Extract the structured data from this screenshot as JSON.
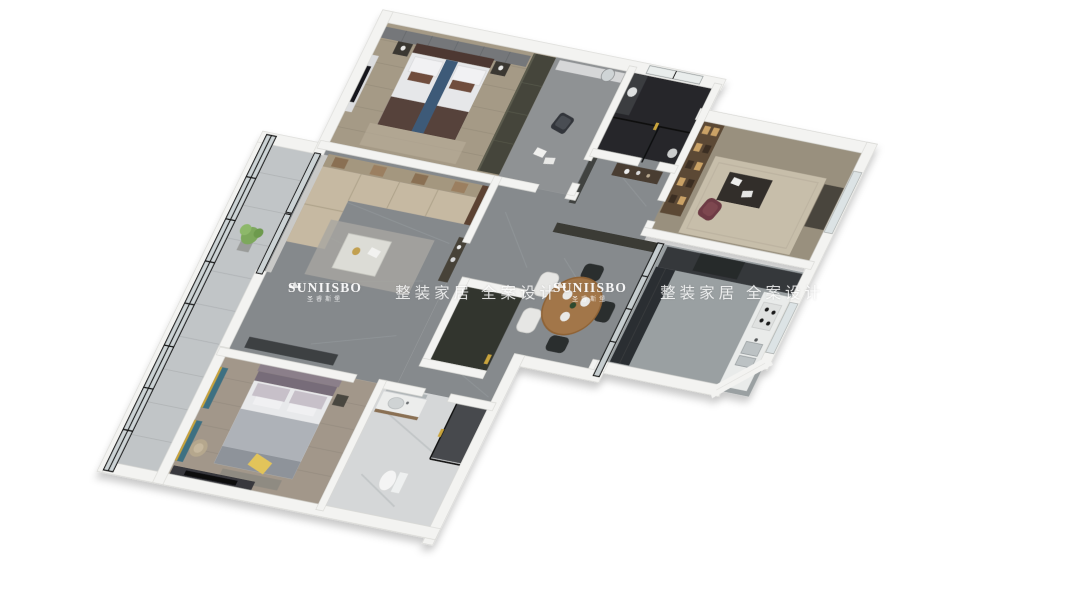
{
  "watermark": {
    "brand": "SUNIISBO",
    "brand_cn": "圣睿斯堡",
    "tagline": "整装家居 全案设计"
  },
  "scene": {
    "type": "3d-dollhouse-floorplan-render",
    "rooms": [
      "bedroom-secondary",
      "dressing-area",
      "bathroom-dark",
      "study",
      "entry-hall",
      "living-room",
      "dining-room",
      "kitchen",
      "hallway",
      "master-bedroom",
      "bathroom-white",
      "balcony"
    ]
  },
  "colors": {
    "background": "#ffffff",
    "wall": "#f3f3f1",
    "floor_marble": "#868a8d",
    "floor_wood": "#a59a86",
    "bathroom_dark_floor": "#26282b",
    "bathroom_light_floor": "#d5d7d8",
    "sofa_beige": "#c6b9a2",
    "bed_blanket_brown": "#57423a",
    "bed_runner_blue": "#3d5a78",
    "curtain_teal": "#3e6f82",
    "pillow_yellow": "#e2c45a",
    "window_frame_black": "#141414",
    "watermark_text": "#ffffff"
  }
}
